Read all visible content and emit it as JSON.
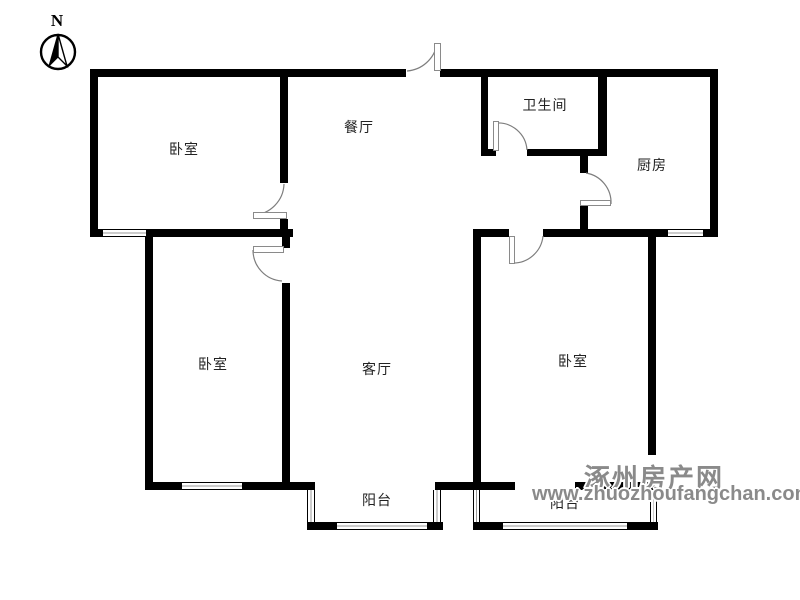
{
  "compass": {
    "label": "N"
  },
  "rooms": {
    "bedroom_top_left": "卧室",
    "dining": "餐厅",
    "bathroom": "卫生间",
    "kitchen": "厨房",
    "bedroom_bottom_left": "卧室",
    "living": "客厅",
    "bedroom_bottom_right": "卧室",
    "balcony_middle": "阳台",
    "balcony_right": "阳台"
  },
  "watermark": {
    "site_name": "涿州房产网",
    "url": "www.zhuozhoufangchan.com",
    "color": "#8a8a8a"
  },
  "colors": {
    "wall": "#000000",
    "background": "#ffffff",
    "door_arc": "#7d7d7d",
    "label_text": "#222222"
  }
}
